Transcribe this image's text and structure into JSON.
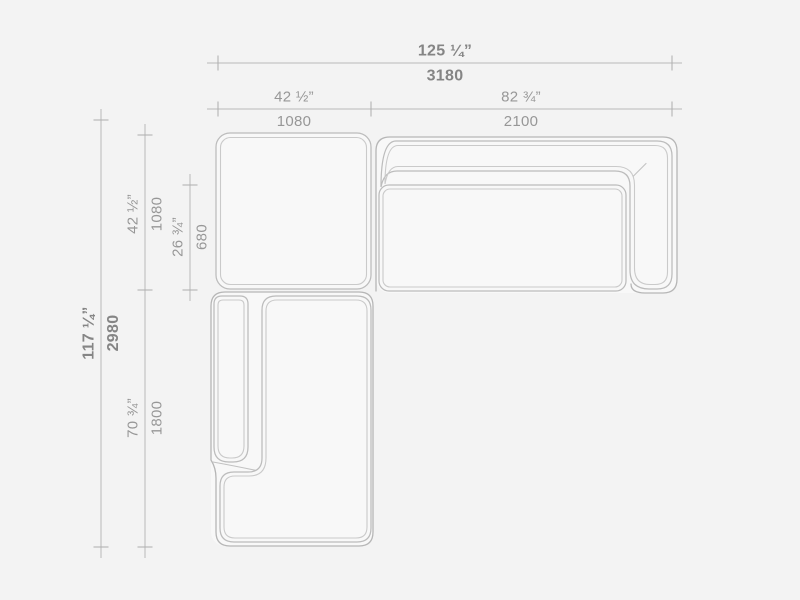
{
  "drawing": {
    "subject": "sectional-sofa-plan-view",
    "colors": {
      "background": "#f3f3f3",
      "module_fill": "#f8f8f8",
      "outline": "#b6b6b6",
      "inner_line": "#cacaca",
      "dimension_line": "#b9b9b9",
      "dimension_text": "#979797",
      "dimension_text_bold": "#858585"
    }
  },
  "dimensions": {
    "overall_width": {
      "in": "125 ¼”",
      "mm": "3180"
    },
    "top_left_width": {
      "in": "42 ½”",
      "mm": "1080"
    },
    "top_right_width": {
      "in": "82 ¾”",
      "mm": "2100"
    },
    "overall_depth": {
      "in": "117 ¼”",
      "mm": "2980"
    },
    "left_top_depth": {
      "in": "42 ½”",
      "mm": "1080"
    },
    "inner_seat_depth": {
      "in": "26 ¾”",
      "mm": "680"
    },
    "left_bottom_length": {
      "in": "70 ¾”",
      "mm": "1800"
    }
  }
}
